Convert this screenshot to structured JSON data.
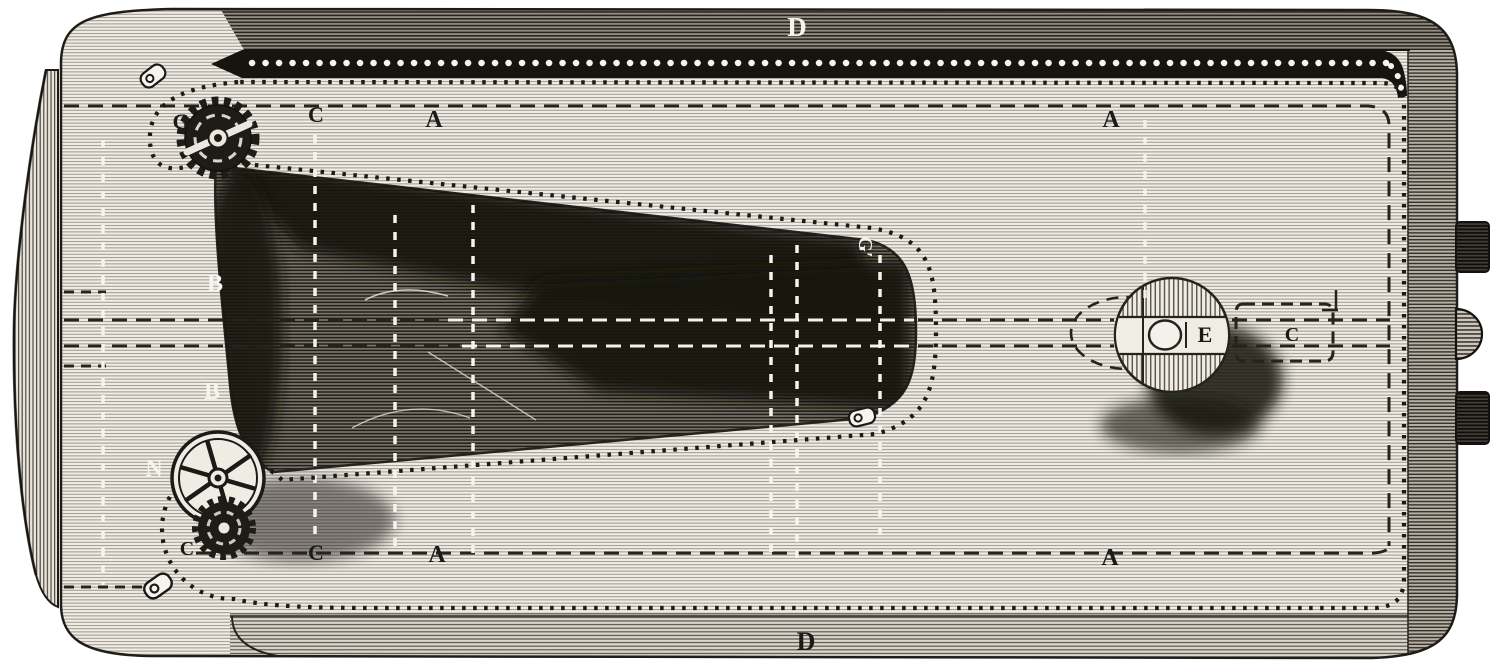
{
  "figure": {
    "kind": "antique engraving — plan view of belt-driven machine bed",
    "labels": {
      "belt_top": "D",
      "belt_bottom": "D",
      "drive_gear": "G",
      "top_track_c": "C",
      "top_track_a_left": "A",
      "top_track_a_right": "A",
      "belt_clasp_mid": "G′",
      "bed_left_upper": "B",
      "bed_left_lower": "B",
      "flywheel": "N",
      "pinion_c": "C",
      "bottom_track_c": "C",
      "bottom_track_a_left": "A",
      "bottom_track_a_right": "A",
      "drum": "E",
      "carriage_c": "C"
    },
    "palette": {
      "paper": "#f6f4ee",
      "ink": "#1c1a16",
      "belt_black": "#17140f",
      "shade_dark": "#15130f"
    }
  }
}
